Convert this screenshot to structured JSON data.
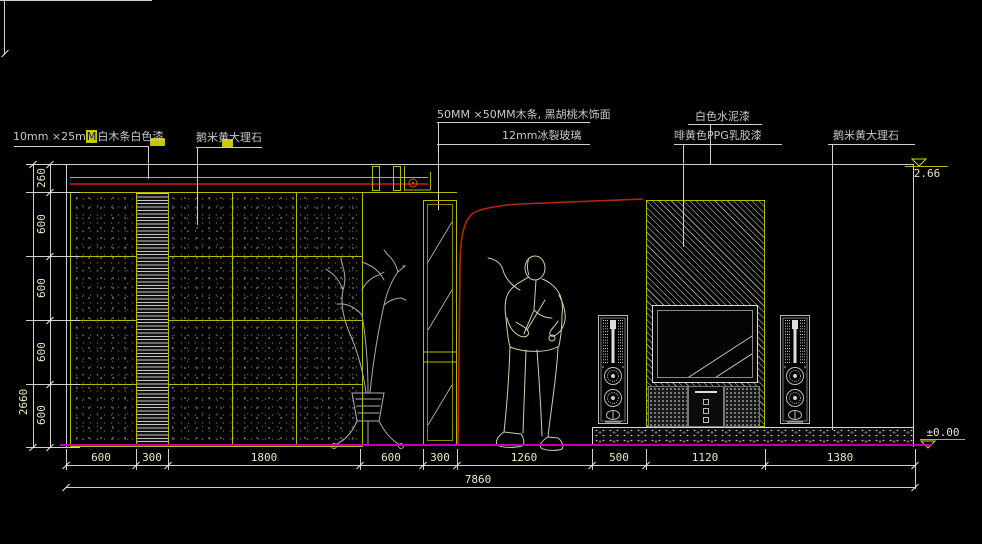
{
  "title": "interior-elevation-cad-drawing",
  "labels": {
    "wood_strip": {
      "p1": "10mm ×25m",
      "hl": "M",
      "p2": "白木条白色漆"
    },
    "marble_left": "鹅米黄大理石",
    "wood_grid": "50MM ×50MM木条, 黑胡桃木饰面",
    "glass": "12mm冰裂玻璃",
    "cement": "白色水泥漆",
    "ppg": "啡黄色PPG乳胶漆",
    "marble_right": "鹅米黄大理石"
  },
  "levels": {
    "top": "2.66",
    "bottom": "±0.00"
  },
  "dims": {
    "left_total": "2660",
    "left_segs": [
      "260",
      "600",
      "600",
      "600",
      "600"
    ],
    "bottom_segs": [
      "600",
      "300",
      "1800",
      "600",
      "300",
      "1260",
      "500",
      "1120",
      "1380"
    ],
    "bottom_total": "7860"
  },
  "colors": {
    "grid_yellow": "#b9b900",
    "dim_text": "#e9e9c0",
    "red_line": "#a01010",
    "arc_red": "#b42510",
    "floor_magenta": "#b800b8",
    "label_text": "#c9c9c9",
    "highlight": "#c8c800"
  }
}
